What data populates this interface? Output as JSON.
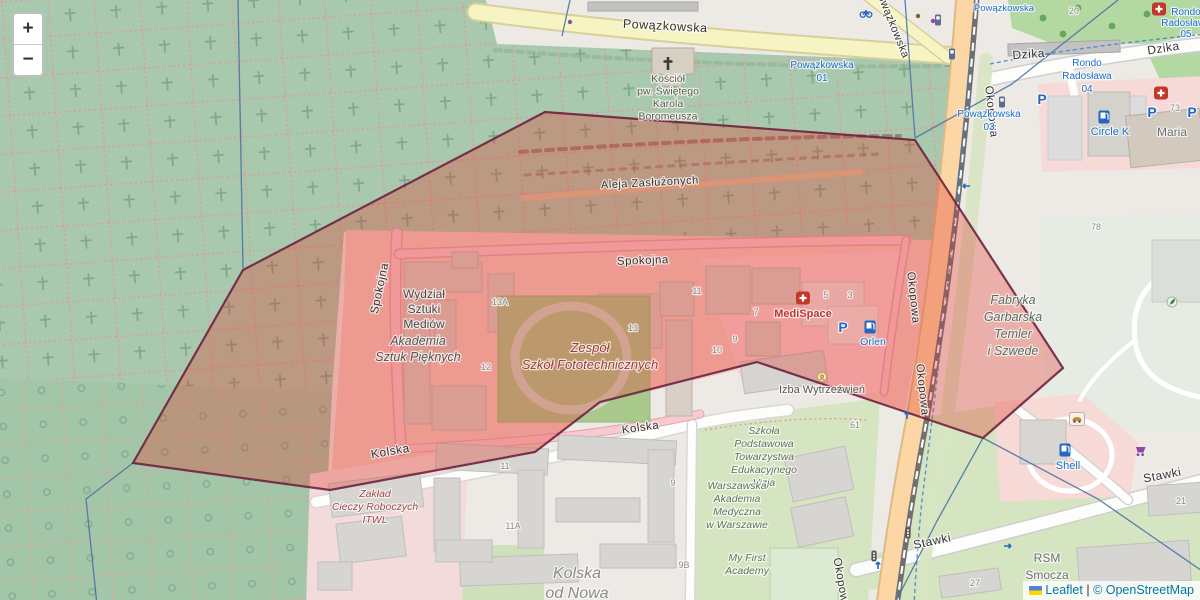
{
  "controls": {
    "zoom_in": "+",
    "zoom_out": "−"
  },
  "attribution": {
    "leaflet": "Leaflet",
    "separator": "|",
    "osm": "© OpenStreetMap",
    "flag_colors": [
      "#4f80e2",
      "#ffd500"
    ]
  },
  "colors": {
    "overlay_fill": "#e0372a",
    "overlay_border": "#6d2240",
    "transit_blue": "#1a6ecc",
    "poi_red": "#c03434",
    "edu_green": "#5f7355",
    "street_gray": "#333333",
    "housenum_gray": "#8a8a8a"
  },
  "overlay": {
    "points": "545,112 915,140 1063,368 983,438 757,362 600,402 535,452 330,490 133,463 243,270",
    "fill": "#e0372a",
    "fill_opacity": 0.33,
    "stroke": "#6d2240",
    "stroke_width": 2.2,
    "stroke_opacity": 0.9
  },
  "street_labels": [
    {
      "text": "Powązkowska",
      "x": 665,
      "y": 30,
      "rot": 3,
      "size": 12.5
    },
    {
      "text": "Powązkowska",
      "x": 889,
      "y": 24,
      "rot": 68,
      "size": 11
    },
    {
      "text": "Okopowa",
      "x": 988,
      "y": 112,
      "rot": 84,
      "size": 11.5
    },
    {
      "text": "Okopowa",
      "x": 910,
      "y": 298,
      "rot": 84,
      "size": 11.5
    },
    {
      "text": "Okopowa",
      "x": 919,
      "y": 390,
      "rot": 84,
      "size": 11.5
    },
    {
      "text": "Okopowa",
      "x": 838,
      "y": 584,
      "rot": 80,
      "size": 11.5
    },
    {
      "text": "Spokojna",
      "x": 383,
      "y": 289,
      "rot": -78,
      "size": 11.5
    },
    {
      "text": "Spokojna",
      "x": 643,
      "y": 264,
      "rot": -2,
      "size": 11.5
    },
    {
      "text": "Aleja Zasłużonych",
      "x": 650,
      "y": 186,
      "rot": -3,
      "size": 11
    },
    {
      "text": "Kolska",
      "x": 391,
      "y": 455,
      "rot": -10,
      "size": 12
    },
    {
      "text": "Kolska",
      "x": 641,
      "y": 431,
      "rot": -8,
      "size": 11.5
    },
    {
      "text": "Stawki",
      "x": 933,
      "y": 545,
      "rot": -12,
      "size": 12
    },
    {
      "text": "Stawki",
      "x": 1163,
      "y": 479,
      "rot": -11,
      "size": 12
    },
    {
      "text": "Dzika",
      "x": 1029,
      "y": 58,
      "rot": -4,
      "size": 12
    },
    {
      "text": "Dzika",
      "x": 1164,
      "y": 52,
      "rot": -9,
      "size": 12
    }
  ],
  "place_labels": [
    {
      "name": "church",
      "lines": [
        "Kościół",
        "pw. Świętego",
        "Karola",
        "Boromeusza"
      ],
      "x": 668,
      "y": 82,
      "lh": 12.5,
      "size": 10.5,
      "color": "#5c5c4a",
      "italic": false
    },
    {
      "name": "wydzial-sztuki-mediow",
      "lines": [
        "Wydział",
        "Sztuki",
        "Mediów"
      ],
      "x": 424,
      "y": 298,
      "lh": 15,
      "size": 12,
      "color": "#4a4a48",
      "italic": false
    },
    {
      "name": "akademia-sztuk-pieknych",
      "lines": [
        "Akademia",
        "Sztuk Pięknych"
      ],
      "x": 418,
      "y": 345,
      "lh": 16,
      "size": 12.5,
      "color": "#55554d",
      "italic": true
    },
    {
      "name": "zespol-szkol",
      "lines": [
        "Zespół",
        "Szkół Fototechnicznych"
      ],
      "x": 590,
      "y": 352,
      "lh": 17,
      "size": 13,
      "color": "#a33c3c",
      "italic": true
    },
    {
      "name": "medispace",
      "lines": [
        "MediSpace"
      ],
      "x": 803,
      "y": 317,
      "lh": 13,
      "size": 11,
      "color": "#c03434",
      "bold": true
    },
    {
      "name": "orlen",
      "lines": [
        "Orlen"
      ],
      "x": 873,
      "y": 345,
      "lh": 13,
      "size": 10.5,
      "color": "#1a6ecc"
    },
    {
      "name": "circle-k",
      "lines": [
        "Circle K"
      ],
      "x": 1110,
      "y": 135,
      "lh": 13,
      "size": 11,
      "color": "#1a6ecc"
    },
    {
      "name": "shell",
      "lines": [
        "Shell"
      ],
      "x": 1068,
      "y": 469,
      "lh": 13,
      "size": 11,
      "color": "#1a6ecc"
    },
    {
      "name": "izba-wytrzezwien",
      "lines": [
        "Izba Wytrzeźwień"
      ],
      "x": 822,
      "y": 393,
      "lh": 13,
      "size": 11,
      "color": "#565656"
    },
    {
      "name": "szkola-vizja",
      "lines": [
        "Szkoła",
        "Podstawowa",
        "Towarzystwa",
        "Edukacyjnego",
        "Vizja"
      ],
      "x": 764,
      "y": 434,
      "lh": 13,
      "size": 10.5,
      "color": "#5f7355",
      "italic": true
    },
    {
      "name": "warszawska-akademia",
      "lines": [
        "Warszawska",
        "Akademia",
        "Medyczna",
        "w Warszawie"
      ],
      "x": 737,
      "y": 489,
      "lh": 13,
      "size": 10.5,
      "color": "#5f7355",
      "italic": true
    },
    {
      "name": "my-first-academy",
      "lines": [
        "My First",
        "Academy"
      ],
      "x": 747,
      "y": 561,
      "lh": 13,
      "size": 10.5,
      "color": "#5f7355",
      "italic": true
    },
    {
      "name": "kolska-od-nowa",
      "lines": [
        "Kolska",
        "od Nowa"
      ],
      "x": 577,
      "y": 578,
      "lh": 20,
      "size": 16,
      "color": "#8a8a88",
      "italic": true
    },
    {
      "name": "itwl",
      "lines": [
        "Zakład",
        "Cieczy Roboczych",
        "ITWL"
      ],
      "x": 375,
      "y": 497,
      "lh": 13,
      "size": 10.5,
      "color": "#a04848",
      "italic": true
    },
    {
      "name": "fabryka-garbarska",
      "lines": [
        "Fabryka",
        "Garbarska",
        "Temler",
        "i Szwede"
      ],
      "x": 1013,
      "y": 304,
      "lh": 17,
      "size": 12.5,
      "color": "#5c6b5e",
      "italic": true
    },
    {
      "name": "rsm-smocza",
      "lines": [
        "RSM",
        "Smocza"
      ],
      "x": 1047,
      "y": 562,
      "lh": 17,
      "size": 12,
      "color": "#6e6e6e"
    },
    {
      "name": "maria",
      "lines": [
        "Maria"
      ],
      "x": 1172,
      "y": 136,
      "lh": 13,
      "size": 12,
      "color": "#6e6e6e"
    }
  ],
  "transit_labels": [
    {
      "name": "powazkowska-01",
      "lines": [
        "Powązkowska",
        "01"
      ],
      "x": 822,
      "y": 68,
      "lh": 13,
      "size": 10
    },
    {
      "name": "powazkowska-03",
      "lines": [
        "Powązkowska",
        "03"
      ],
      "x": 989,
      "y": 117,
      "lh": 13,
      "size": 10
    },
    {
      "name": "powazkowska-top",
      "lines": [
        "Powązkowska"
      ],
      "x": 1004,
      "y": 11,
      "lh": 12,
      "size": 9.5
    },
    {
      "name": "rondo-radoslawa-04",
      "lines": [
        "Rondo",
        "Radosława",
        "04"
      ],
      "x": 1087,
      "y": 66,
      "lh": 13,
      "size": 10
    },
    {
      "name": "rondo-radoslawa-05",
      "lines": [
        "Rondo",
        "Radosława",
        "05"
      ],
      "x": 1186,
      "y": 15,
      "lh": 11,
      "size": 10
    }
  ],
  "house_numbers": [
    {
      "text": "20",
      "x": 1074,
      "y": 14
    },
    {
      "text": "73",
      "x": 1175,
      "y": 111
    },
    {
      "text": "78",
      "x": 1096,
      "y": 230
    },
    {
      "text": "13A",
      "x": 500,
      "y": 305
    },
    {
      "text": "12",
      "x": 486,
      "y": 370
    },
    {
      "text": "13",
      "x": 633,
      "y": 331
    },
    {
      "text": "11",
      "x": 697,
      "y": 294
    },
    {
      "text": "10",
      "x": 717,
      "y": 353
    },
    {
      "text": "9",
      "x": 735,
      "y": 342
    },
    {
      "text": "5",
      "x": 826,
      "y": 298
    },
    {
      "text": "3",
      "x": 850,
      "y": 298
    },
    {
      "text": "7",
      "x": 756,
      "y": 315
    },
    {
      "text": "61",
      "x": 855,
      "y": 428
    },
    {
      "text": "11",
      "x": 505,
      "y": 469
    },
    {
      "text": "11A",
      "x": 513,
      "y": 529
    },
    {
      "text": "9",
      "x": 673,
      "y": 486
    },
    {
      "text": "9B",
      "x": 684,
      "y": 568
    },
    {
      "text": "27",
      "x": 975,
      "y": 586
    },
    {
      "text": "21",
      "x": 1181,
      "y": 504
    }
  ],
  "icons": [
    {
      "type": "church-cross",
      "x": 668,
      "y": 64
    },
    {
      "type": "hospital",
      "x": 803,
      "y": 298
    },
    {
      "type": "hospital",
      "x": 1161,
      "y": 93
    },
    {
      "type": "hospital",
      "x": 1159,
      "y": 9
    },
    {
      "type": "parking",
      "x": 843,
      "y": 327
    },
    {
      "type": "parking",
      "x": 1042,
      "y": 99
    },
    {
      "type": "parking",
      "x": 1152,
      "y": 112
    },
    {
      "type": "parking",
      "x": 1192,
      "y": 112
    },
    {
      "type": "fuel",
      "x": 870,
      "y": 327
    },
    {
      "type": "fuel",
      "x": 1104,
      "y": 117
    },
    {
      "type": "fuel",
      "x": 1065,
      "y": 450
    },
    {
      "type": "carwash",
      "x": 1077,
      "y": 419
    },
    {
      "type": "cart",
      "x": 1141,
      "y": 451
    },
    {
      "type": "bus-stop",
      "x": 952,
      "y": 54
    },
    {
      "type": "bus-stop",
      "x": 1002,
      "y": 102
    },
    {
      "type": "bus-stop",
      "x": 938,
      "y": 20
    },
    {
      "type": "traffic-signal",
      "x": 908,
      "y": 533
    },
    {
      "type": "traffic-signal",
      "x": 874,
      "y": 556
    },
    {
      "type": "bicycle",
      "x": 866,
      "y": 13
    },
    {
      "type": "tree",
      "x": 1043,
      "y": 18
    },
    {
      "type": "tree",
      "x": 1078,
      "y": 8
    },
    {
      "type": "tree",
      "x": 1112,
      "y": 26
    },
    {
      "type": "tree",
      "x": 1147,
      "y": 14
    },
    {
      "type": "tree",
      "x": 1063,
      "y": 34
    },
    {
      "type": "leaf",
      "x": 1172,
      "y": 302
    },
    {
      "type": "poi-amber",
      "x": 822,
      "y": 377
    },
    {
      "type": "dot",
      "x": 918,
      "y": 16,
      "color": "#8a5a2a"
    },
    {
      "type": "dot",
      "x": 933,
      "y": 21,
      "color": "#9147a8"
    },
    {
      "type": "dot",
      "x": 570,
      "y": 22,
      "color": "#9147a8"
    },
    {
      "type": "arrow",
      "x": 966,
      "y": 186,
      "rot": 180
    },
    {
      "type": "arrow",
      "x": 907,
      "y": 415,
      "rot": -90
    },
    {
      "type": "arrow",
      "x": 1008,
      "y": 546,
      "rot": 0
    },
    {
      "type": "arrow",
      "x": 878,
      "y": 565,
      "rot": -90
    }
  ]
}
